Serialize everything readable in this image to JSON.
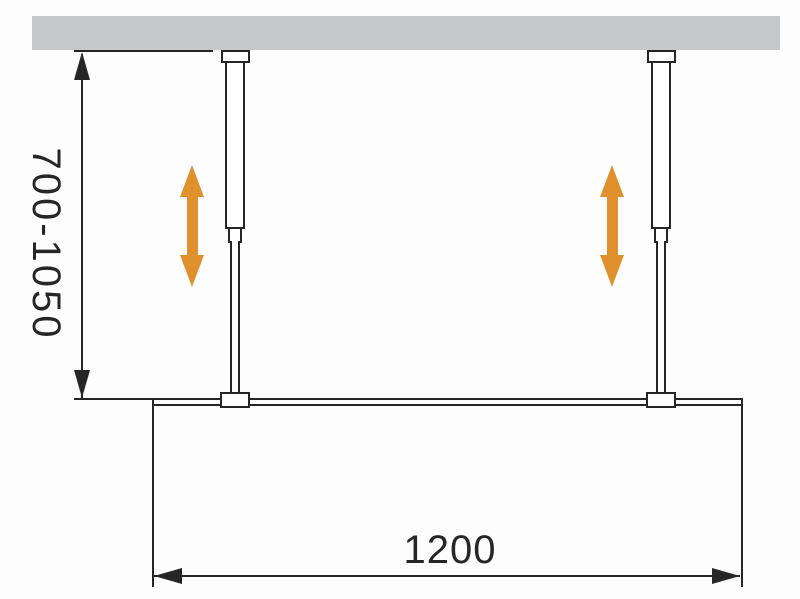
{
  "diagram": {
    "description": "Installation drawing of a walk-in glass panel fixed by two adjustable ceiling support bars",
    "labels": {
      "height_range": "700-1050",
      "width": "1200"
    },
    "colors": {
      "background": "#fdfdfd",
      "ceiling_gray": "#c6c7c8",
      "line_black": "#262626",
      "arrow_orange": "#e0912d"
    },
    "icons": {
      "adjust_arrows": "double-headed-vertical-arrow",
      "dimension_arrowheads": "solid-triangle"
    }
  }
}
